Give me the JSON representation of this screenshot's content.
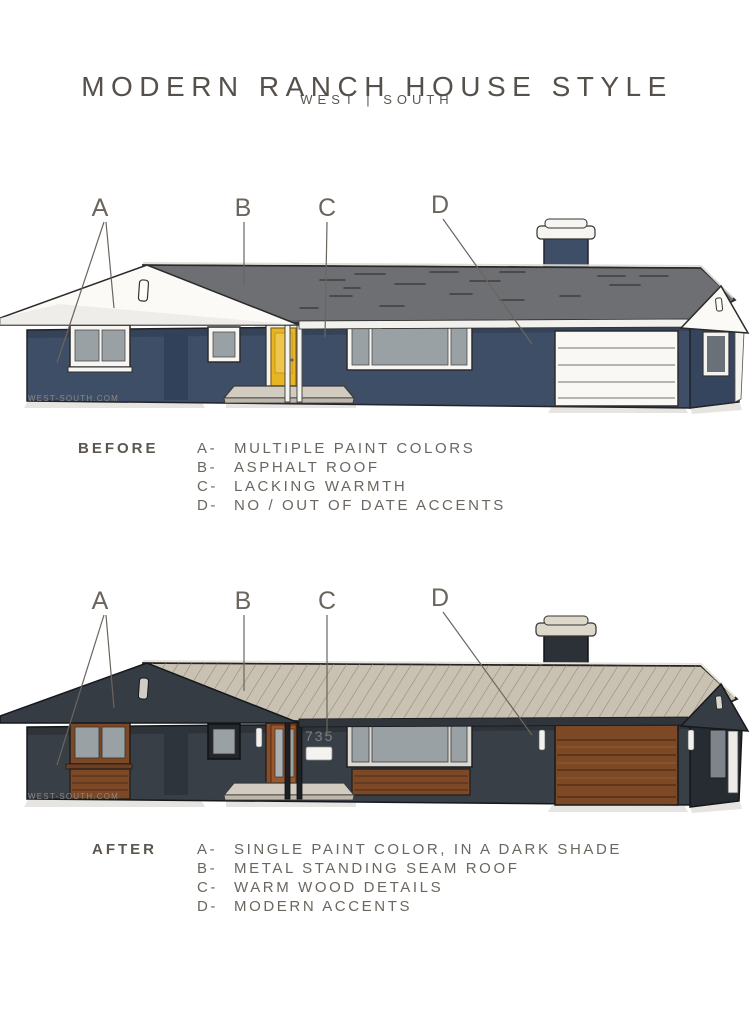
{
  "header": {
    "title": "MODERN RANCH HOUSE STYLE",
    "subtitle": "WEST | SOUTH"
  },
  "watermark": "WEST-SOUTH.COM",
  "diagram_labels": [
    "A",
    "B",
    "C",
    "D"
  ],
  "before": {
    "heading": "BEFORE",
    "callouts": [
      {
        "letter": "A-",
        "text": "MULTIPLE PAINT COLORS"
      },
      {
        "letter": "B-",
        "text": "ASPHALT ROOF"
      },
      {
        "letter": "C-",
        "text": "LACKING WARMTH"
      },
      {
        "letter": "D-",
        "text": "NO / OUT OF DATE ACCENTS"
      }
    ]
  },
  "after": {
    "heading": "AFTER",
    "house_number": "735",
    "callouts": [
      {
        "letter": "A-",
        "text": "SINGLE PAINT COLOR, IN A DARK SHADE"
      },
      {
        "letter": "B-",
        "text": "METAL STANDING SEAM ROOF"
      },
      {
        "letter": "C-",
        "text": "WARM WOOD DETAILS"
      },
      {
        "letter": "D-",
        "text": "MODERN ACCENTS"
      }
    ]
  },
  "colors": {
    "before_wall": "#3d4e66",
    "before_wall_shadow": "#31415a",
    "before_roof": "#6e6f72",
    "gable_white": "#fbfaf7",
    "door_yellow": "#e7b424",
    "after_wall": "#393f47",
    "after_gable": "#363c44",
    "after_roof": "#c9c1b2",
    "wood": "#7c4826",
    "glass": "#9aa1a5",
    "porch": "#d2ccc0",
    "label_text": "#6b655d",
    "title_text": "#55504a"
  }
}
